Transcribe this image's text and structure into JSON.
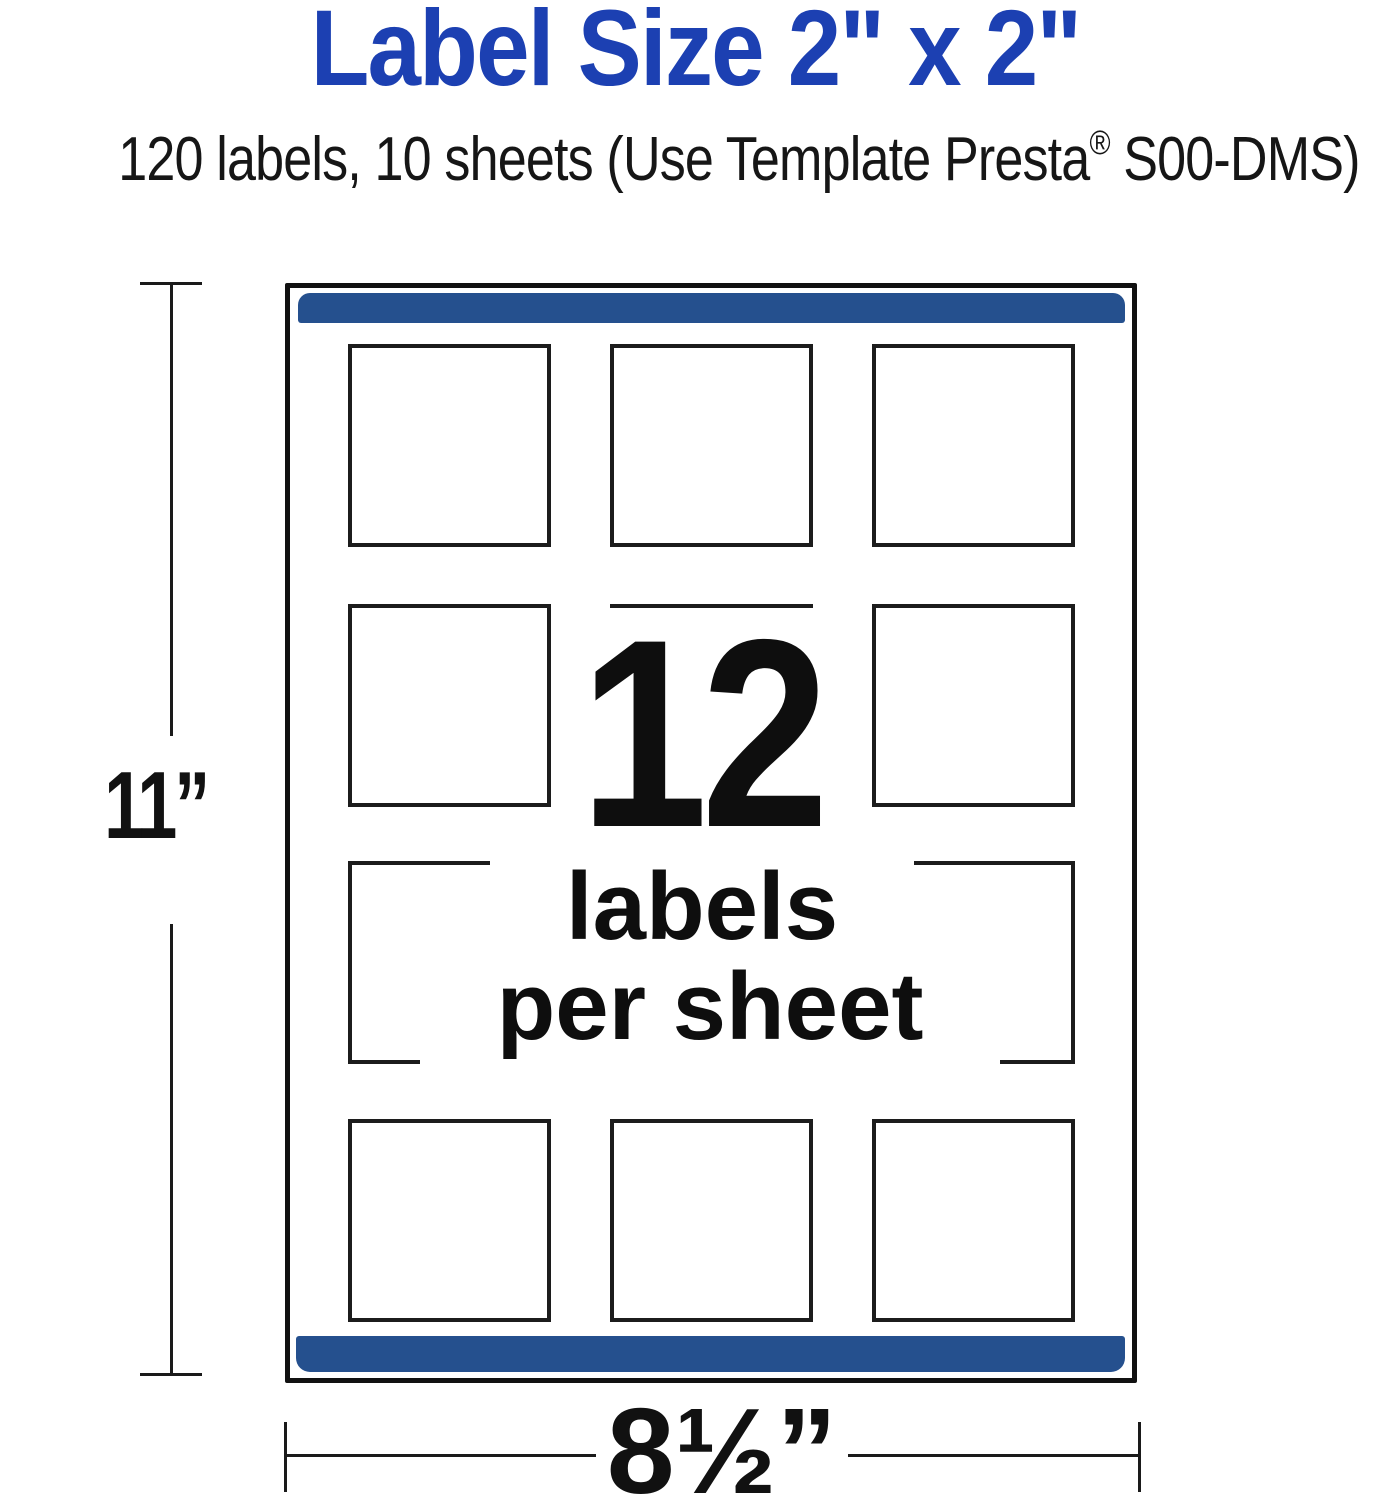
{
  "page": {
    "title": "Label Size 2\" x 2\"",
    "subtitle_pre": "120 labels, 10 sheets (Use Template Presta",
    "subtitle_reg": "®",
    "subtitle_post": " S00-DMS)"
  },
  "sheet": {
    "center_count": "12",
    "center_line1": "labels",
    "center_line2": "per sheet",
    "grid": {
      "rows": 4,
      "cols": 3
    }
  },
  "dimensions": {
    "height_label": "11”",
    "width_label": "8½”"
  },
  "colors": {
    "title_blue": "#1c40b2",
    "bar_blue": "#25508e",
    "line_black": "#1a1a1a"
  }
}
